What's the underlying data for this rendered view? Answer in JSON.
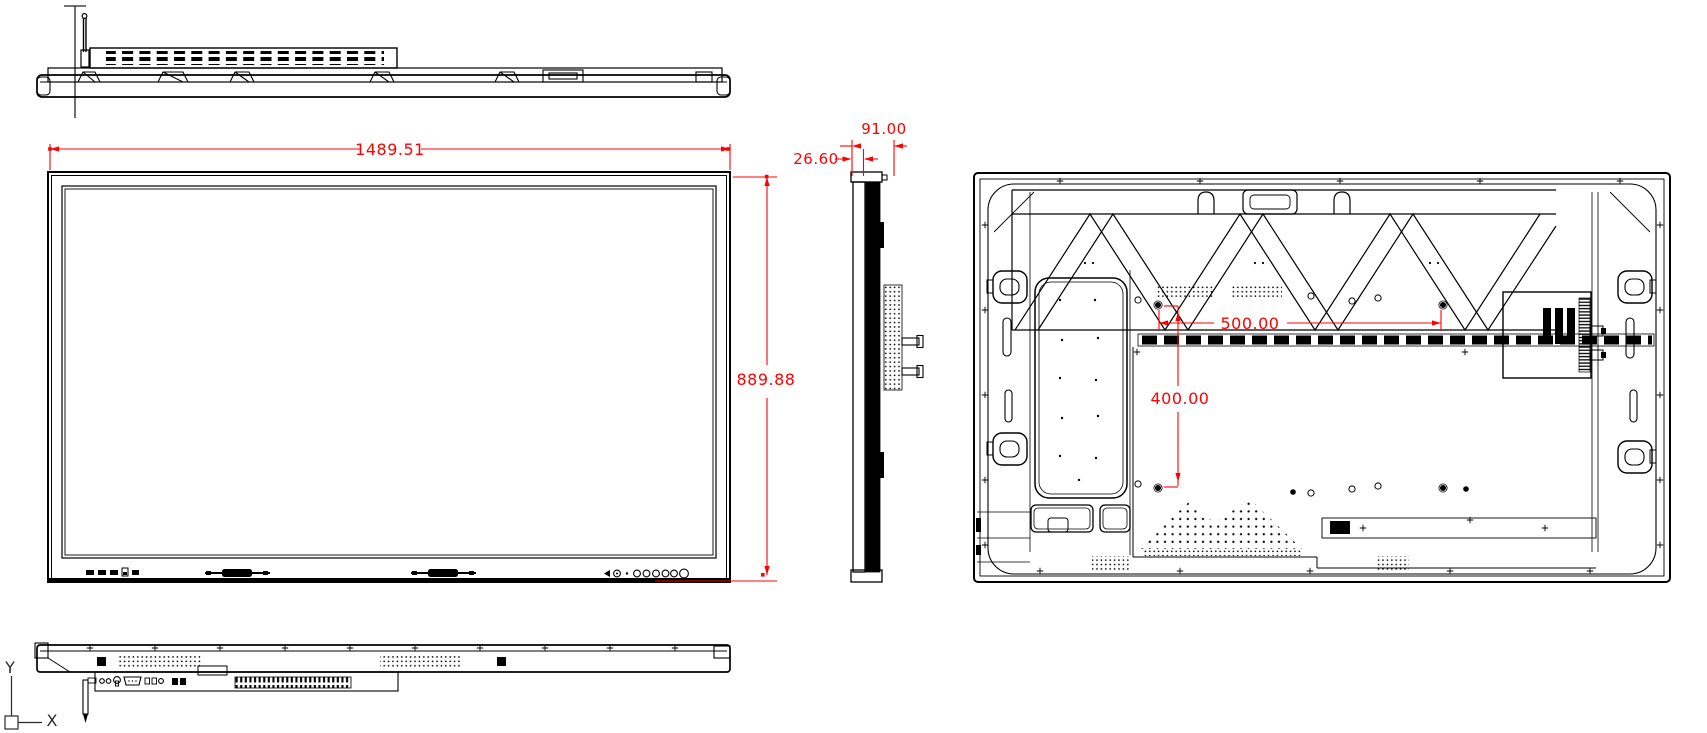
{
  "page": {
    "background": "#ffffff"
  },
  "drawing": {
    "line_color": "#000000",
    "dimension_color": "#ff0000",
    "dimensions": {
      "overall_width": "1489.51",
      "overall_height": "889.88",
      "bezel_depth": "26.60",
      "total_depth": "91.00",
      "vesa_width": "500.00",
      "vesa_height": "400.00"
    },
    "axis": {
      "y_label": "Y",
      "x_label": "X"
    }
  }
}
